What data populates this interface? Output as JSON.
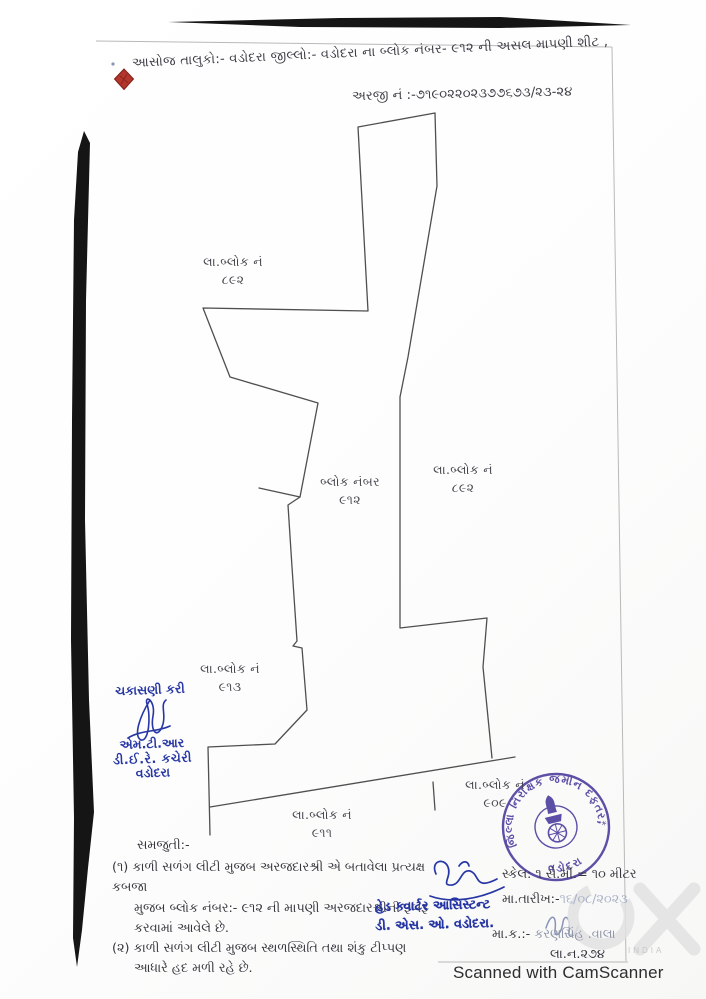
{
  "header": {
    "title_line": "આસોજ તાલુકો:- વડોદરા જીલ્લો:- વડોદરા ના બ્લોક નંબર- ૯૧૨ ની અસલ માપણી શીટ ,",
    "application_no": "અરજી નં :-૭૧૯૦૨૨૦૨૩૭૭૬૭૩/૨૩-૨૪"
  },
  "map": {
    "labels": [
      {
        "id": "block-892-top",
        "line1": "લા.બ્લોક નં",
        "line2": "૮૯૨"
      },
      {
        "id": "block-912",
        "line1": "બ્લોક નંબર",
        "line2": "૯૧૨"
      },
      {
        "id": "block-892-right",
        "line1": "લા.બ્લોક નં",
        "line2": "૮૯૨"
      },
      {
        "id": "block-913",
        "line1": "લા.બ્લોક નં",
        "line2": "૯૧૩"
      },
      {
        "id": "block-911",
        "line1": "લા.બ્લોક નં",
        "line2": "૯૧૧"
      },
      {
        "id": "block-909",
        "line1": "લા.બ્લોક નં",
        "line2": "૯૦૯"
      }
    ]
  },
  "verification_note": {
    "line1": "ચકાસણી કરી",
    "line2": "એમ.ટી.આર",
    "line3": "ડી.ઈ.રે. કચેરી",
    "line4": "વડોદરા"
  },
  "notes": {
    "heading": "સમજુતી:-",
    "item1_line1": "(૧) કાળી સળંગ લીટી મુજબ અરજદારશ્રી એ બતાવેલા પ્રત્યક્ષ કબજા",
    "item1_line2": "મુજબ બ્લોક નંબર:- ૯૧૨ ની માપણી અરજદારશ્રીની  રૂબરૂ",
    "item1_line3": "કરવામાં આવેલે છે.",
    "item2_line1": "(૨) કાળી સળંગ લીટી મુજબ સ્થળસ્થિતિ તથા શંકુ ટીપ્પણ",
    "item2_line2": "આધારે હદ મળી રહે છે."
  },
  "officer_stamp": {
    "line1": "હેડ ક્વાર્ટર આસિસ્ટન્ટ",
    "line2": "ડી. એસ. ઓ. વડોદરા."
  },
  "measurement": {
    "scale": "સ્કેલ: ૧ સે.મી.= ૧૦ મીટર",
    "date_label": "મા.તારીખ:-",
    "date_value": "૧૬/૦૮/૨૦૨૩",
    "surveyor_label": "મા.ક.:-",
    "surveyor_value": " કરણસિંહ .વાલા",
    "register_no": "લા.ન.૨૭૪"
  },
  "round_stamp": {
    "text_top": "જિલ્લા નિરીક્ષક જમીન દફતર,",
    "text_bottom": "વડોદરા",
    "separator": "*"
  },
  "footer": {
    "scanned_by": "Scanned with CamScanner",
    "watermark_small": "INDIA"
  },
  "colors": {
    "blue_ink": "#2636a4",
    "purple_stamp": "#4c3d9e",
    "red_seal": "#b3352b",
    "map_line": "#4f4f4f",
    "scan_edge_black": "#151515"
  }
}
